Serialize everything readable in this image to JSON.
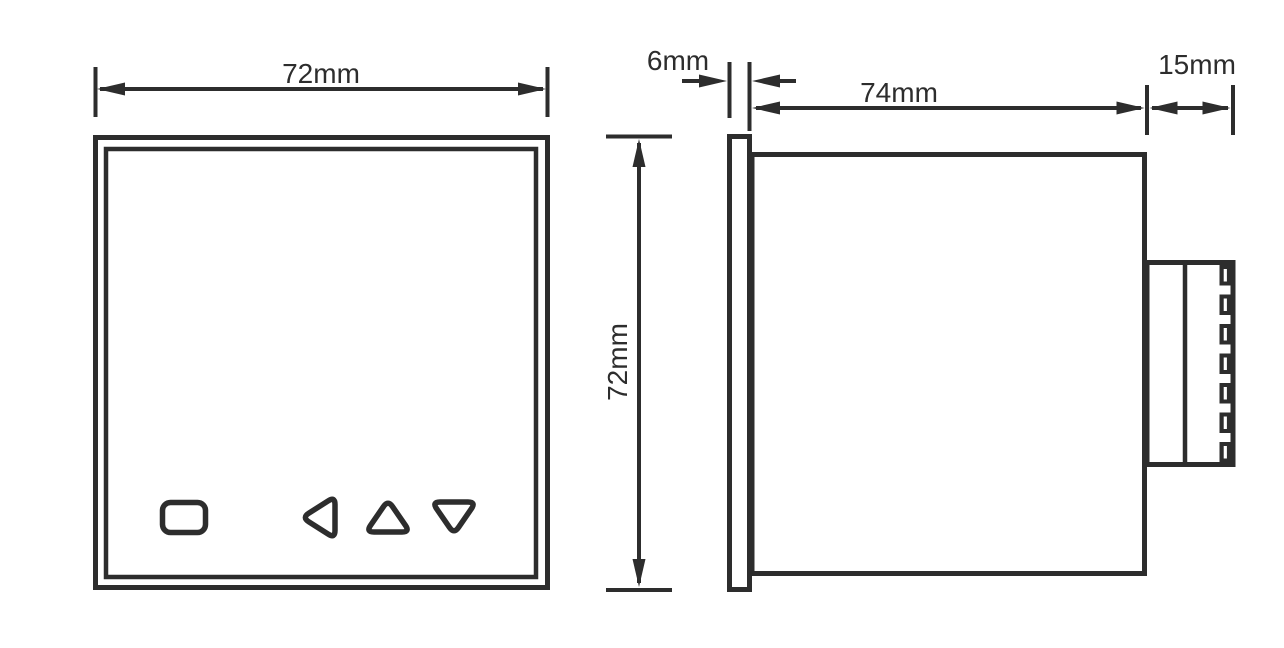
{
  "drawing": {
    "type": "technical-dimension-drawing",
    "subject": "panel-meter-enclosure",
    "front_view": {
      "width_dimension_label": "72mm",
      "height_dimension_label": "72mm",
      "buttons": [
        "set",
        "left",
        "up",
        "down"
      ]
    },
    "side_view": {
      "bezel_depth_label": "6mm",
      "body_depth_label": "74mm",
      "terminal_depth_label": "15mm",
      "terminal_count": 7
    }
  },
  "colors": {
    "line": "#2d2d2d",
    "background": "#ffffff"
  }
}
